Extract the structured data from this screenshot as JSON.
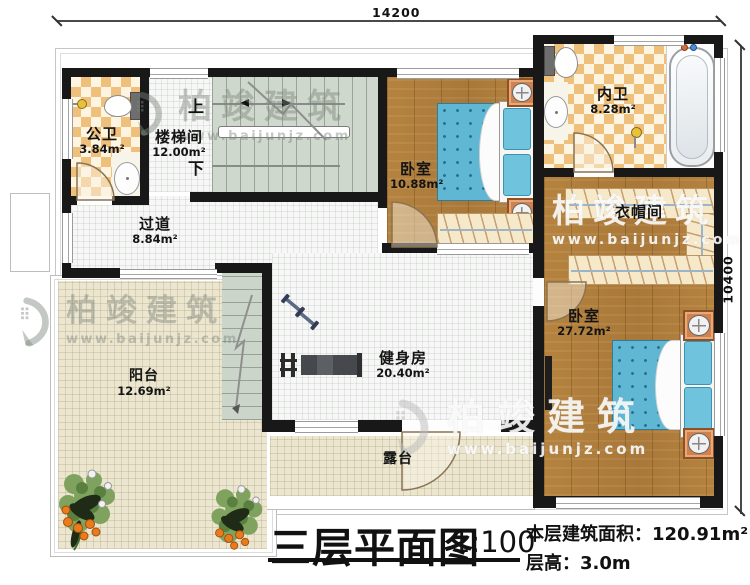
{
  "dimensions": {
    "top": "14200",
    "right": "10400"
  },
  "rooms": [
    {
      "id": "public-bath",
      "name": "公卫",
      "area": "3.84m²"
    },
    {
      "id": "stairwell",
      "name": "楼梯间",
      "area": "12.00m²"
    },
    {
      "id": "hallway",
      "name": "过道",
      "area": "8.84m²"
    },
    {
      "id": "bedroom-small",
      "name": "卧室",
      "area": "10.88m²"
    },
    {
      "id": "master-bath",
      "name": "内卫",
      "area": "8.28m²"
    },
    {
      "id": "cloakroom",
      "name": "衣帽间",
      "area": ""
    },
    {
      "id": "bedroom-master",
      "name": "卧室",
      "area": "27.72m²"
    },
    {
      "id": "gym",
      "name": "健身房",
      "area": "20.40m²"
    },
    {
      "id": "balcony",
      "name": "阳台",
      "area": "12.69m²"
    },
    {
      "id": "terrace",
      "name": "露台",
      "area": ""
    }
  ],
  "stairs": {
    "up": "上",
    "down": "下"
  },
  "title": {
    "main": "三层平面图",
    "scale": "1:100",
    "area_line": "本层建筑面积：120.91m²",
    "height_line": "层高：3.0m"
  },
  "watermark": {
    "brand": "柏竣建筑",
    "url": "www.baijunjz.com"
  },
  "colors": {
    "wall": "#181818",
    "wood_floor": "#b2803e",
    "tile_checker": "#eec07c",
    "bed": "#5fb7d4",
    "outdoor_floor": "#ece6d0",
    "stair_floor": "#cfd8cd",
    "nightstand": "#d0814e"
  }
}
